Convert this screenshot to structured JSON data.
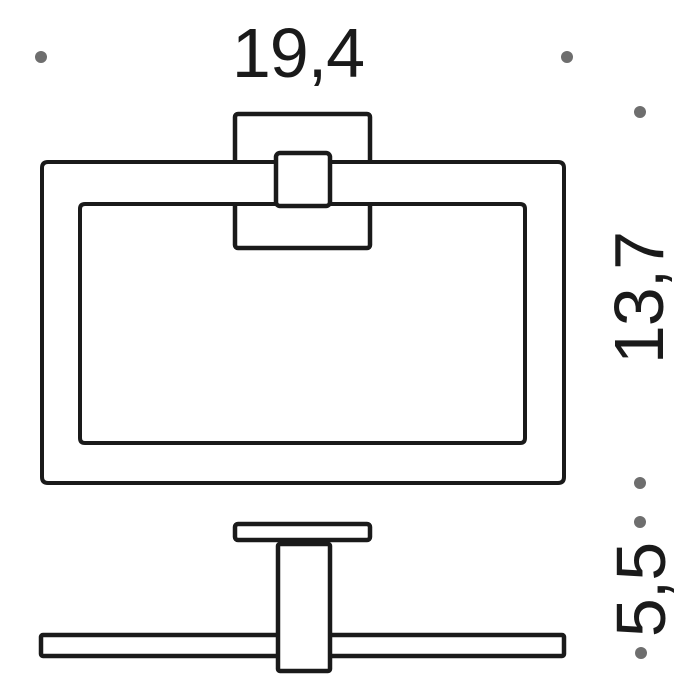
{
  "drawing": {
    "kind": "technical dimension diagram",
    "views": {
      "front": "towel ring with square wall plate",
      "side": "wall plate profile with post and rail"
    },
    "labels": {
      "width": "19,4",
      "height": "13,7",
      "depth": "5,5"
    },
    "colors": {
      "line": "#1a1a1a",
      "dot": "#6e6e6e",
      "background": "#ffffff"
    }
  }
}
